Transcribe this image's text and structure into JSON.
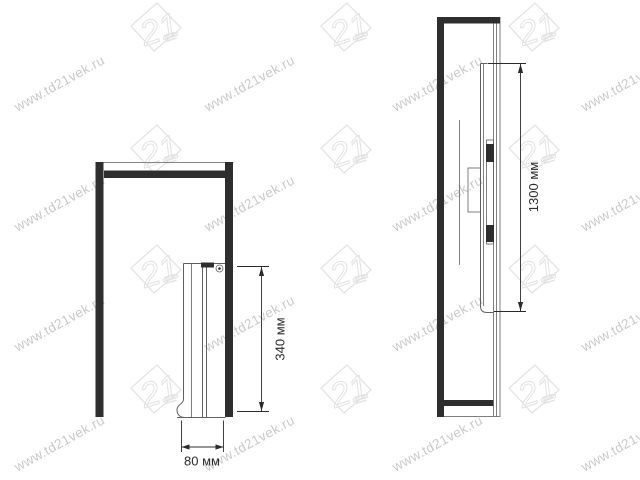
{
  "watermark": {
    "url_text": "www.td21vek.ru",
    "logo_text": "21"
  },
  "front_view": {
    "height_dim_label": "340 мм",
    "width_dim_label": "80 мм"
  },
  "side_view": {
    "height_dim_label": "1300 мм"
  },
  "colors": {
    "background": "#ffffff",
    "line_dark": "#2e2e2e",
    "line_thin": "#606060",
    "dim_color": "#2b2b2b",
    "watermark_text": "#c9c9c9",
    "watermark_logo": "#e3e3e3"
  }
}
